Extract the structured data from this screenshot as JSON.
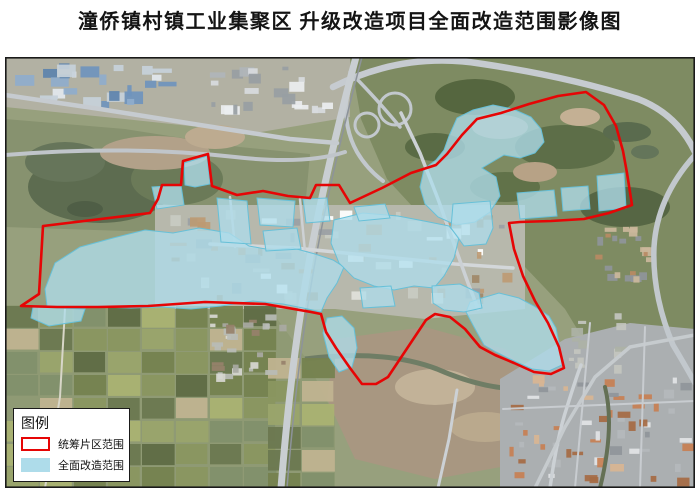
{
  "title": "潼侨镇村镇工业集聚区 升级改造项目全面改造范围影像图",
  "legend": {
    "title": "图例",
    "items": [
      {
        "label": "统筹片区范围",
        "swatch": "red-outline",
        "color": "#e60505"
      },
      {
        "label": "全面改造范围",
        "swatch": "blue-fill",
        "color": "#aedcea"
      }
    ]
  },
  "map": {
    "frame_color": "#1a1a1a",
    "boundary_color": "#e60505",
    "renovation_fill": "#aedcea",
    "renovation_stroke": "#67c0d8",
    "red_polygon": [
      [
        38,
        169
      ],
      [
        145,
        156
      ],
      [
        153,
        142
      ],
      [
        157,
        128
      ],
      [
        176,
        128
      ],
      [
        178,
        104
      ],
      [
        203,
        97
      ],
      [
        207,
        129
      ],
      [
        232,
        138
      ],
      [
        258,
        134
      ],
      [
        283,
        139
      ],
      [
        305,
        141
      ],
      [
        311,
        128
      ],
      [
        334,
        128
      ],
      [
        345,
        146
      ],
      [
        377,
        131
      ],
      [
        406,
        116
      ],
      [
        431,
        108
      ],
      [
        442,
        97
      ],
      [
        457,
        78
      ],
      [
        472,
        62
      ],
      [
        496,
        56
      ],
      [
        524,
        47
      ],
      [
        553,
        39
      ],
      [
        581,
        35
      ],
      [
        599,
        48
      ],
      [
        611,
        69
      ],
      [
        618,
        94
      ],
      [
        622,
        116
      ],
      [
        627,
        148
      ],
      [
        604,
        156
      ],
      [
        579,
        162
      ],
      [
        546,
        164
      ],
      [
        515,
        165
      ],
      [
        504,
        166
      ],
      [
        509,
        192
      ],
      [
        518,
        219
      ],
      [
        530,
        244
      ],
      [
        543,
        266
      ],
      [
        554,
        290
      ],
      [
        559,
        311
      ],
      [
        546,
        317
      ],
      [
        529,
        315
      ],
      [
        509,
        306
      ],
      [
        490,
        298
      ],
      [
        475,
        290
      ],
      [
        460,
        272
      ],
      [
        445,
        260
      ],
      [
        430,
        257
      ],
      [
        421,
        263
      ],
      [
        401,
        293
      ],
      [
        383,
        320
      ],
      [
        371,
        327
      ],
      [
        357,
        327
      ],
      [
        345,
        311
      ],
      [
        331,
        291
      ],
      [
        321,
        275
      ],
      [
        316,
        257
      ],
      [
        306,
        255
      ],
      [
        260,
        247
      ],
      [
        200,
        245
      ],
      [
        143,
        249
      ],
      [
        93,
        250
      ],
      [
        52,
        250
      ],
      [
        16,
        249
      ],
      [
        34,
        237
      ]
    ],
    "blue_polygons": [
      [
        [
          179,
          106
        ],
        [
          202,
          99
        ],
        [
          205,
          127
        ],
        [
          190,
          130
        ],
        [
          180,
          128
        ]
      ],
      [
        [
          147,
          130
        ],
        [
          176,
          128
        ],
        [
          179,
          148
        ],
        [
          152,
          152
        ]
      ],
      [
        [
          40,
          232
        ],
        [
          50,
          206
        ],
        [
          75,
          190
        ],
        [
          108,
          181
        ],
        [
          140,
          173
        ],
        [
          168,
          176
        ],
        [
          194,
          171
        ],
        [
          224,
          176
        ],
        [
          244,
          189
        ],
        [
          266,
          193
        ],
        [
          288,
          191
        ],
        [
          310,
          197
        ],
        [
          328,
          203
        ],
        [
          339,
          210
        ],
        [
          332,
          226
        ],
        [
          322,
          241
        ],
        [
          316,
          255
        ],
        [
          303,
          252
        ],
        [
          278,
          247
        ],
        [
          248,
          244
        ],
        [
          216,
          249
        ],
        [
          186,
          252
        ],
        [
          156,
          250
        ],
        [
          126,
          251
        ],
        [
          94,
          250
        ],
        [
          60,
          250
        ],
        [
          42,
          249
        ]
      ],
      [
        [
          28,
          250
        ],
        [
          80,
          252
        ],
        [
          76,
          264
        ],
        [
          44,
          269
        ],
        [
          26,
          261
        ]
      ],
      [
        [
          212,
          141
        ],
        [
          242,
          144
        ],
        [
          246,
          187
        ],
        [
          216,
          185
        ]
      ],
      [
        [
          252,
          141
        ],
        [
          290,
          144
        ],
        [
          288,
          170
        ],
        [
          255,
          168
        ]
      ],
      [
        [
          258,
          174
        ],
        [
          292,
          171
        ],
        [
          296,
          192
        ],
        [
          261,
          194
        ]
      ],
      [
        [
          298,
          142
        ],
        [
          322,
          141
        ],
        [
          325,
          164
        ],
        [
          301,
          166
        ]
      ],
      [
        [
          329,
          163
        ],
        [
          358,
          156
        ],
        [
          393,
          159
        ],
        [
          419,
          164
        ],
        [
          444,
          169
        ],
        [
          454,
          181
        ],
        [
          449,
          201
        ],
        [
          439,
          219
        ],
        [
          429,
          231
        ],
        [
          409,
          229
        ],
        [
          389,
          233
        ],
        [
          369,
          229
        ],
        [
          349,
          221
        ],
        [
          334,
          206
        ],
        [
          326,
          186
        ]
      ],
      [
        [
          349,
          150
        ],
        [
          380,
          147
        ],
        [
          385,
          161
        ],
        [
          354,
          164
        ]
      ],
      [
        [
          444,
          79
        ],
        [
          452,
          61
        ],
        [
          468,
          53
        ],
        [
          488,
          48
        ],
        [
          508,
          52
        ],
        [
          526,
          60
        ],
        [
          536,
          72
        ],
        [
          539,
          85
        ],
        [
          530,
          96
        ],
        [
          515,
          101
        ],
        [
          499,
          98
        ],
        [
          487,
          105
        ],
        [
          477,
          111
        ],
        [
          491,
          120
        ],
        [
          495,
          139
        ],
        [
          485,
          155
        ],
        [
          470,
          165
        ],
        [
          451,
          168
        ],
        [
          433,
          160
        ],
        [
          420,
          147
        ],
        [
          415,
          130
        ],
        [
          419,
          112
        ],
        [
          431,
          103
        ],
        [
          439,
          93
        ]
      ],
      [
        [
          512,
          136
        ],
        [
          549,
          133
        ],
        [
          552,
          159
        ],
        [
          515,
          162
        ]
      ],
      [
        [
          556,
          131
        ],
        [
          583,
          129
        ],
        [
          585,
          152
        ],
        [
          558,
          154
        ]
      ],
      [
        [
          592,
          119
        ],
        [
          619,
          116
        ],
        [
          621,
          151
        ],
        [
          594,
          154
        ]
      ],
      [
        [
          477,
          241
        ],
        [
          494,
          236
        ],
        [
          514,
          241
        ],
        [
          529,
          249
        ],
        [
          544,
          259
        ],
        [
          551,
          271
        ],
        [
          555,
          291
        ],
        [
          557,
          308
        ],
        [
          544,
          314
        ],
        [
          527,
          312
        ],
        [
          507,
          303
        ],
        [
          491,
          295
        ],
        [
          479,
          288
        ],
        [
          469,
          270
        ],
        [
          461,
          255
        ],
        [
          465,
          245
        ]
      ],
      [
        [
          427,
          229
        ],
        [
          455,
          227
        ],
        [
          474,
          236
        ],
        [
          477,
          251
        ],
        [
          459,
          255
        ],
        [
          439,
          253
        ],
        [
          428,
          246
        ]
      ],
      [
        [
          448,
          147
        ],
        [
          485,
          144
        ],
        [
          488,
          171
        ],
        [
          481,
          187
        ],
        [
          459,
          189
        ],
        [
          446,
          171
        ]
      ],
      [
        [
          322,
          261
        ],
        [
          337,
          259
        ],
        [
          349,
          271
        ],
        [
          352,
          291
        ],
        [
          347,
          310
        ],
        [
          334,
          315
        ],
        [
          324,
          300
        ],
        [
          318,
          276
        ]
      ],
      [
        [
          355,
          231
        ],
        [
          386,
          229
        ],
        [
          390,
          249
        ],
        [
          358,
          251
        ]
      ]
    ]
  }
}
